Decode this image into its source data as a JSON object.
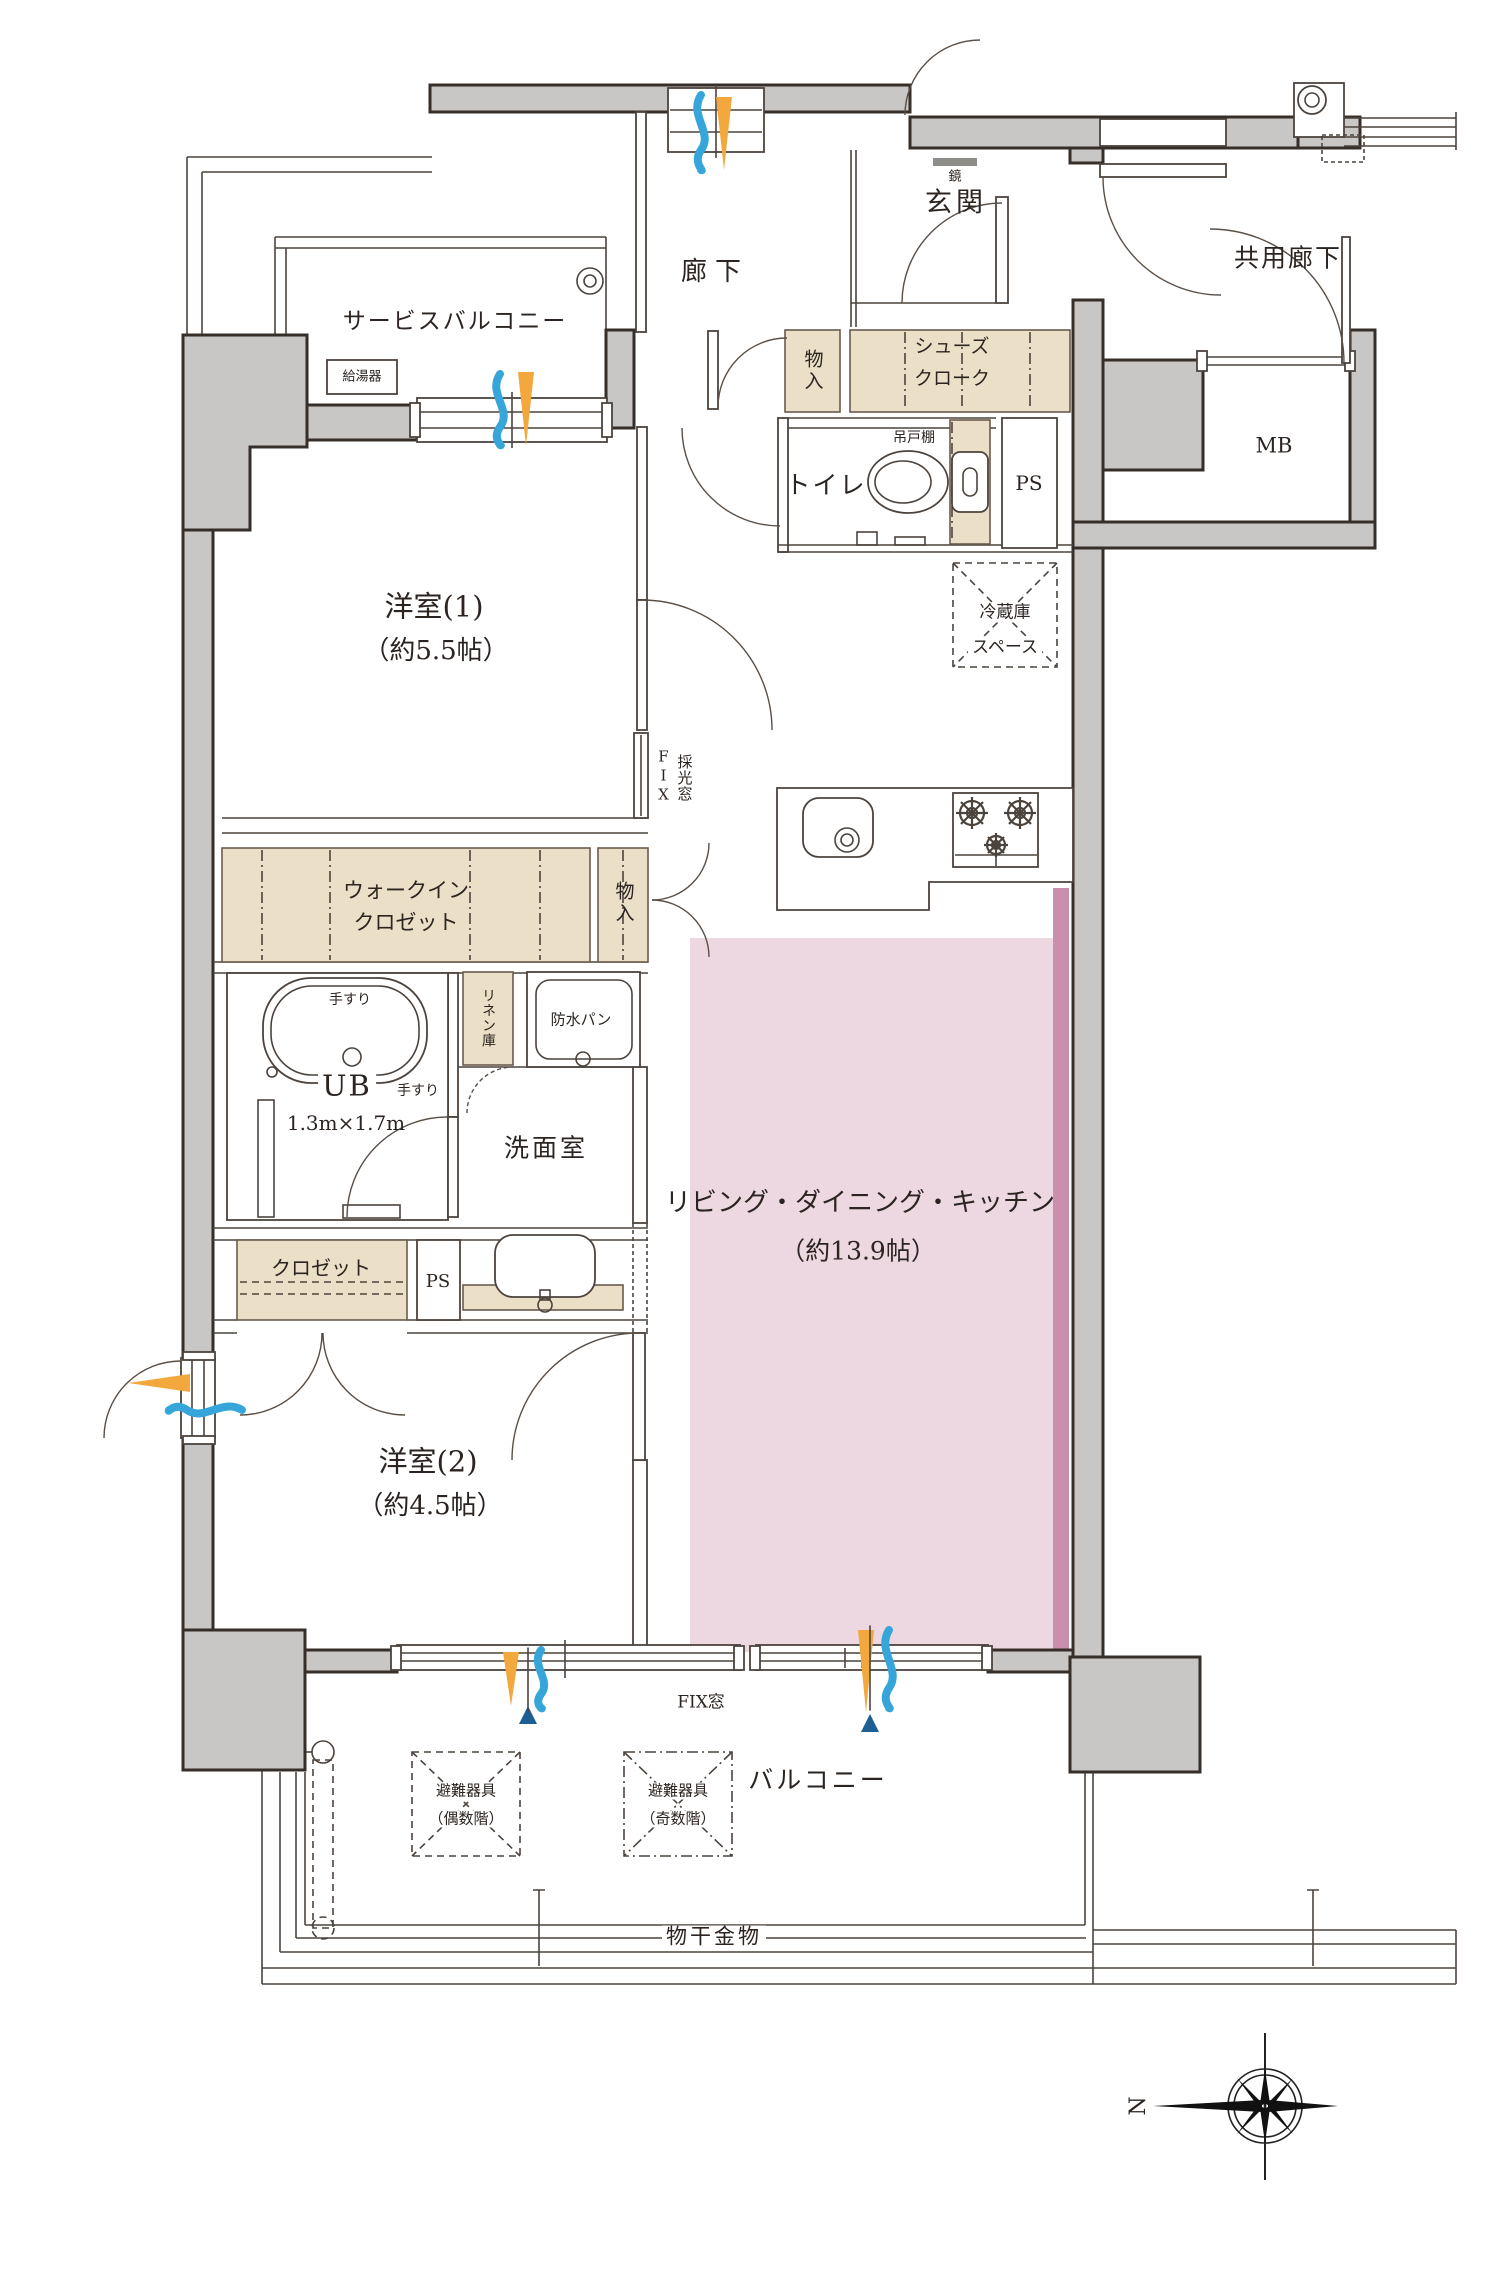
{
  "plan": {
    "rooms": {
      "service_balcony": "サービスバルコニー",
      "rouka": "廊下",
      "genkan": "玄関",
      "kyoyo_rouka": "共用廊下",
      "yoshitsu1": "洋室(1)",
      "yoshitsu1_size": "（約5.5帖）",
      "toilet": "トイレ",
      "mb": "MB",
      "ps_upper": "PS",
      "ps_lower": "PS",
      "ub": "UB",
      "ub_size": "1.3m×1.7m",
      "senmen": "洗面室",
      "ldk": "リビング・ダイニング・キッチン",
      "ldk_size": "（約13.9帖）",
      "yoshitsu2": "洋室(2)",
      "yoshitsu2_size": "（約4.5帖）",
      "balcony": "バルコニー"
    },
    "storage": {
      "shoes_line1": "シューズ",
      "shoes_line2": "クローク",
      "monoiri_hall": "物入",
      "monoiri_kitchen": "物入",
      "wic_line1": "ウォークイン",
      "wic_line2": "クロゼット",
      "closet": "クロゼット",
      "linen": "リネン庫",
      "tsuridana": "吊戸棚",
      "fridge_line1": "冷蔵庫",
      "fridge_line2": "スペース"
    },
    "labels": {
      "kyutoki": "給湯器",
      "kagami": "鏡",
      "bousui_pan": "防水パン",
      "tesuri_top": "手すり",
      "tesuri_side": "手すり",
      "fix_mado": "FIX窓",
      "fix_vertical": "FIX",
      "saiko_mado": "採光窓",
      "monohoshi": "物干金物",
      "hinan_even_line1": "避難器具",
      "hinan_even_line2": "（偶数階）",
      "hinan_odd_line1": "避難器具",
      "hinan_odd_line2": "（奇数階）",
      "compass_n": "N"
    },
    "colors": {
      "wall": "#c8c7c5",
      "wall_stroke": "#362e29",
      "beige": "#ebdfc7",
      "ldk_pink": "#edd8e1",
      "pink_stripe": "#cb8fae",
      "airflow_orange": "#f2a83d",
      "airflow_blue": "#36a6da",
      "airflow_dark_blue": "#1d5f92",
      "line": "#4c433d"
    }
  }
}
